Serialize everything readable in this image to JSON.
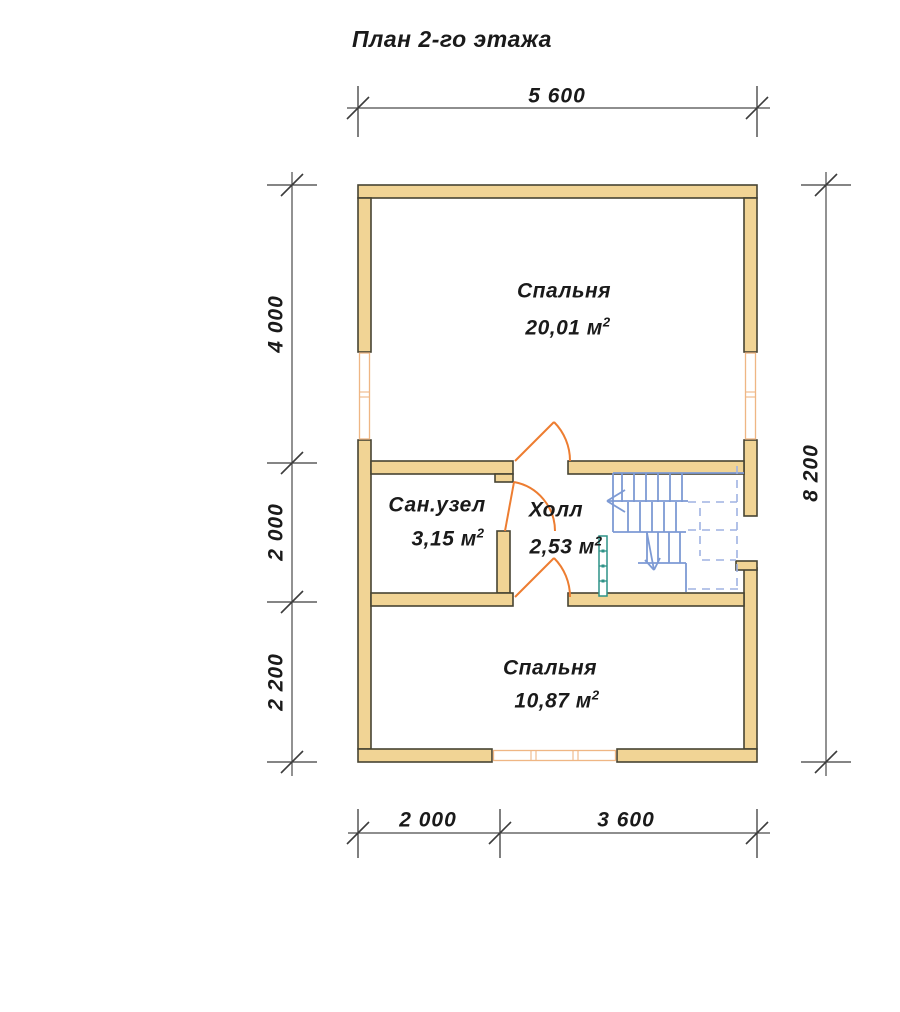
{
  "title": "План 2-го этажа",
  "dimensions": {
    "top": [
      "5 600"
    ],
    "left": [
      "4 000",
      "2 000",
      "2 200"
    ],
    "right": [
      "8 200"
    ],
    "bottom": [
      "2 000",
      "3 600"
    ]
  },
  "rooms": {
    "bedroom_top": {
      "name": "Спальня",
      "area": "20,01 м",
      "sup": "2"
    },
    "bathroom": {
      "name": "Сан.узел",
      "area": "3,15 м",
      "sup": "2"
    },
    "hall": {
      "name": "Холл",
      "area": "2,53 м",
      "sup": "2"
    },
    "bedroom_bottom": {
      "name": "Спальня",
      "area": "10,87 м",
      "sup": "2"
    }
  },
  "colors": {
    "wall_fill": "#F1D495",
    "wall_outline": "#474433",
    "door": "#ED7D31",
    "window": "#EFB684",
    "stair": "#7D9AD4",
    "stair_dash": "#9FB2E2",
    "railing": "#2D9287",
    "dim": "#4A4A4A",
    "text": "#1A1A1A",
    "bg": "#FFFFFF"
  }
}
